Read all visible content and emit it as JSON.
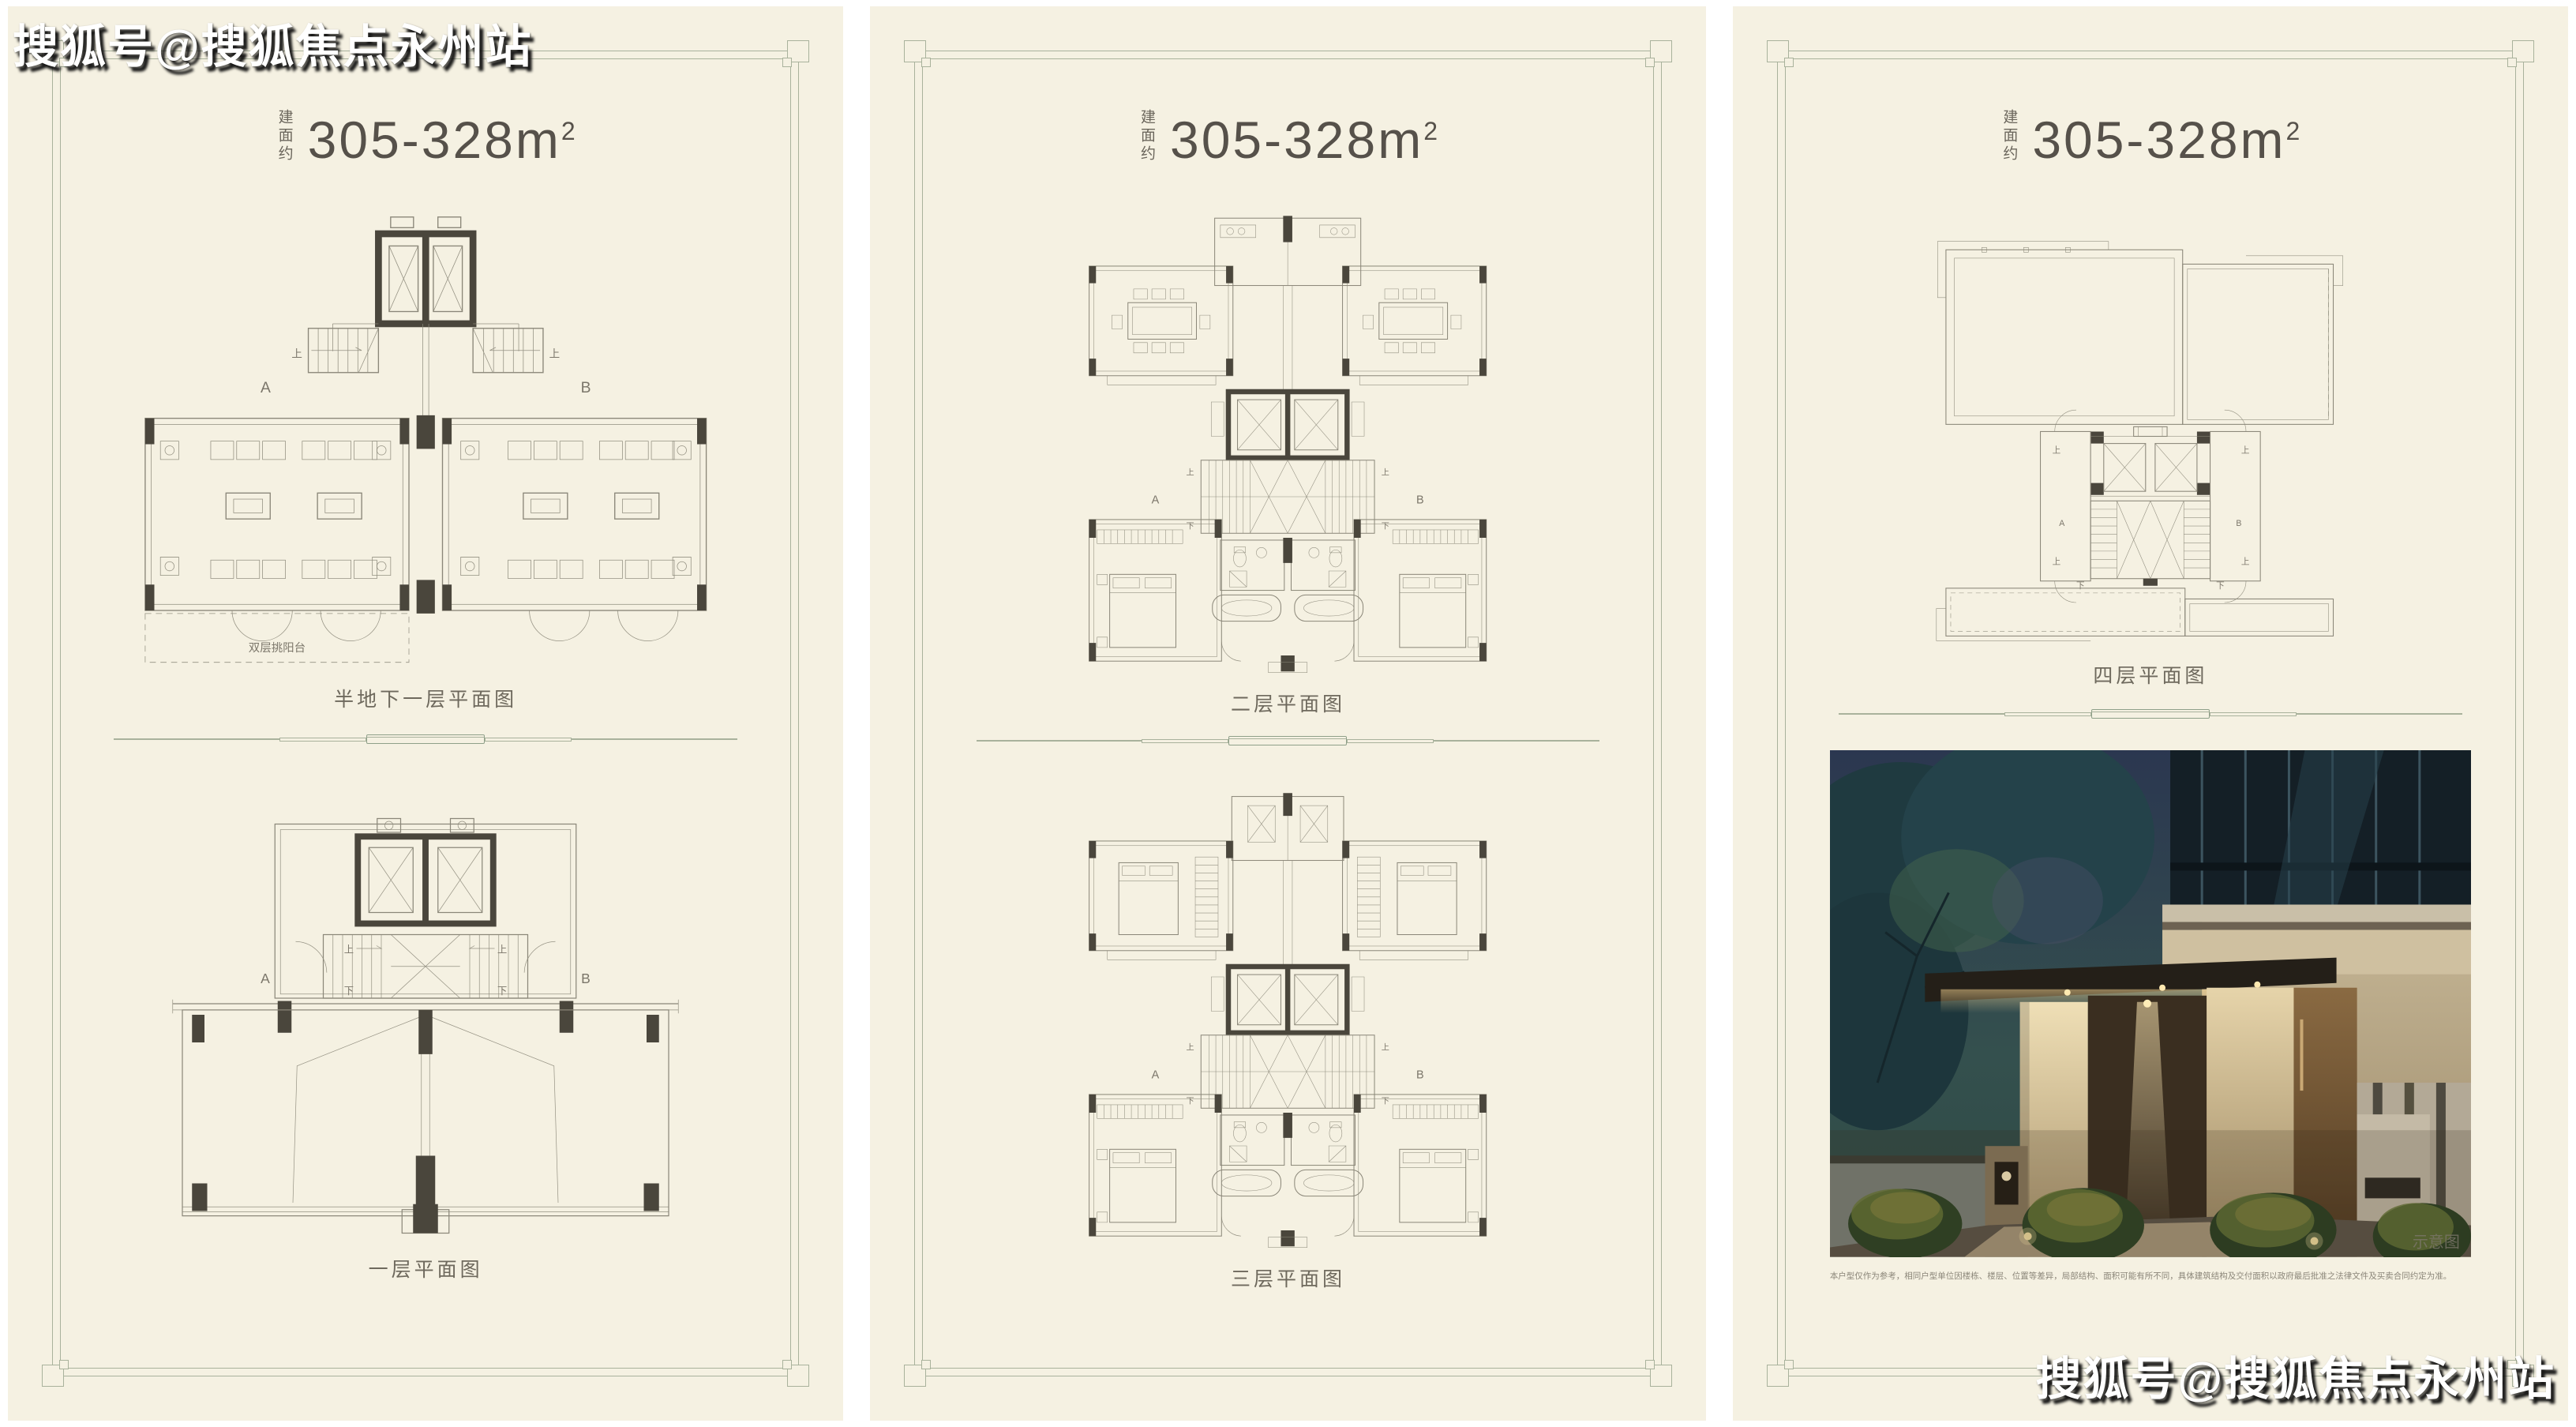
{
  "colors": {
    "panel_bg": "#f5f1e2",
    "frame_line": "#a9b29c",
    "title_ink": "#56514a",
    "plan_line": "#8b8779",
    "wall_fill": "#4a463c",
    "caption_ink": "#6e695d"
  },
  "watermark": {
    "text": "搜狐号@搜狐焦点永州站"
  },
  "shared_labels": {
    "unit_a": "A",
    "unit_b": "B",
    "up": "上",
    "down": "下"
  },
  "panels": [
    {
      "area_prefix": "建面约",
      "area_range": "305-328",
      "area_unit": "m",
      "area_sup": "2",
      "plans": [
        {
          "caption": "半地下一层平面图",
          "annotation": "双层挑阳台"
        },
        {
          "caption": "一层平面图"
        }
      ]
    },
    {
      "area_prefix": "建面约",
      "area_range": "305-328",
      "area_unit": "m",
      "area_sup": "2",
      "plans": [
        {
          "caption": "二层平面图"
        },
        {
          "caption": "三层平面图"
        }
      ]
    },
    {
      "area_prefix": "建面约",
      "area_range": "305-328",
      "area_unit": "m",
      "area_sup": "2",
      "plans": [
        {
          "caption": "四层平面图"
        }
      ],
      "photo": {
        "tag": "示意图"
      },
      "disclaimer": "本户型仅作为参考，相同户型单位因楼栋、楼层、位置等差异，局部结构、面积可能有所不同，具体建筑结构及交付面积以政府最后批准之法律文件及买卖合同约定为准。"
    }
  ]
}
